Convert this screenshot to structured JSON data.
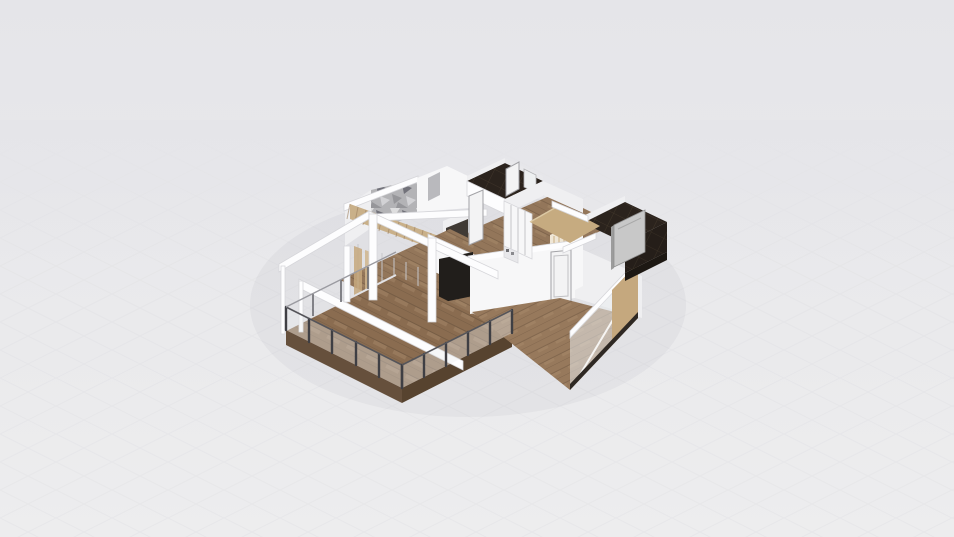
{
  "canvas": {
    "width": 954,
    "height": 537
  },
  "scene": {
    "view": "3d-isometric-floorplan-render",
    "rooms": [
      "terrace-deck",
      "living-room",
      "hallway",
      "wardrobe-closet",
      "bathroom-top",
      "bathroom-right",
      "corridor",
      "bedroom"
    ],
    "objects": [
      "pergola-beams",
      "glass-railing",
      "staircase",
      "geometric-accent-wall",
      "tv-unit",
      "kitchen-unit",
      "sliding-wardrobe",
      "shower-cabin",
      "interior-doors",
      "glass-wall-panel",
      "wall-shelves",
      "tan-platform"
    ]
  },
  "colors": {
    "bg_top": "#e5e5e9",
    "bg_bottom": "#ededee",
    "grid_line": "#d8d8dd",
    "wall_white": "#f7f7f8",
    "wall_bright": "#fdfdfe",
    "wall_mid": "#efeff1",
    "wall_dim": "#e8e8eb",
    "wall_edge": "#d6d6da",
    "floor_wood": "#93765a",
    "floor_wood_plank": "#6e563f",
    "floor_wood_streak": "#a78a6a",
    "deck_wood": "#8a6c50",
    "deck_side": "#66503c",
    "deck_side_dark": "#57432f",
    "bedroom_wood": "#97795c",
    "stair_wood": "#c9b089",
    "platform_wood": "#c6ab80",
    "tan_panel": "#c5a87e",
    "dark_tile": "#2b231d",
    "dark_tile_line": "#473b2e",
    "tv_black": "#211e1b",
    "kitchen_dark": "#403a35",
    "shower_gray": "#c8c8c8",
    "shower_gray_dark": "#9c9c9c",
    "railing_dark": "#3f3f44",
    "glass_tint": "#e9edee",
    "door_fill": "#f3f3f4",
    "door_frame": "#a2a2a6",
    "accent_base": "#b3b3b6",
    "accent_light": "#dededf",
    "accent_pale": "#d2d2d5",
    "accent_mid": "#96969a",
    "accent_dark": "#72727a",
    "ground_shadow": "rgba(100,100,120,0.06)"
  }
}
